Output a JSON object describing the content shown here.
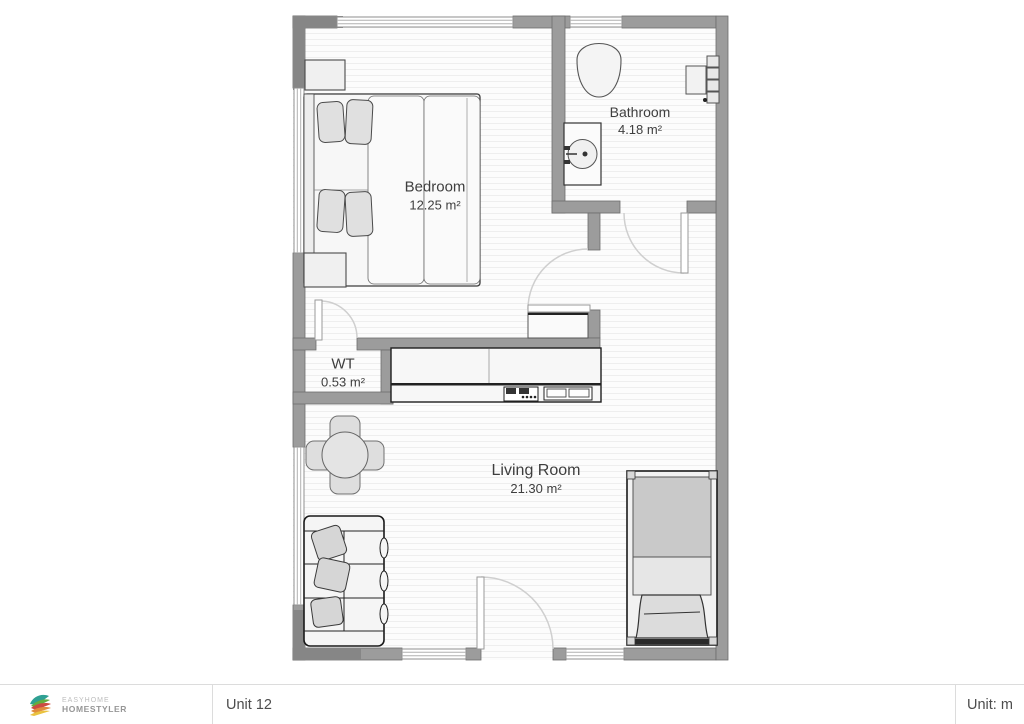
{
  "plan": {
    "rooms": {
      "bedroom": {
        "name": "Bedroom",
        "area": "12.25 m²"
      },
      "bathroom": {
        "name": "Bathroom",
        "area": "4.18 m²"
      },
      "wt": {
        "name": "WT",
        "area": "0.53 m²"
      },
      "living": {
        "name": "Living Room",
        "area": "21.30 m²"
      }
    },
    "icons": {
      "furniture": [
        "double-bed",
        "nightstand",
        "toilet",
        "bathroom-sink",
        "vanity-unit",
        "kitchen-counter",
        "cooktop",
        "kitchen-sink",
        "dining-table",
        "dining-chair",
        "sofa",
        "daybed",
        "hall-cabinet",
        "door-leaf",
        "door-swing-arc",
        "window"
      ]
    },
    "colors": {
      "wall": "#9c9c9c",
      "wall_dark": "#868686",
      "wall_outline": "#6d6d6d",
      "floor_stripe": "#eeeeee",
      "label_text": "#3e3e3e",
      "furniture_outline": "#2a2a2a"
    }
  },
  "footer": {
    "brand_top": "EASYHOME",
    "brand_bottom": "HOMESTYLER",
    "project_name": "Unit 12",
    "unit_label": "Unit: m",
    "logo_colors": [
      "#2fa093",
      "#64ad3e",
      "#cc4a41",
      "#e08b3c",
      "#eac23f"
    ]
  }
}
